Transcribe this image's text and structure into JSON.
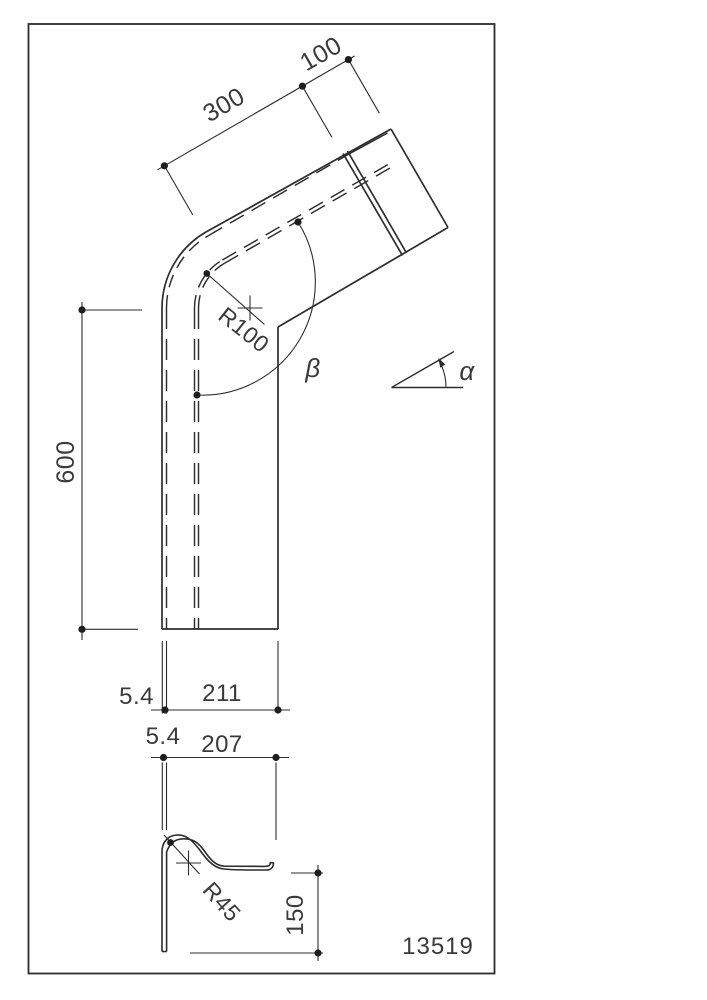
{
  "style": {
    "ink": "#2d2d2d",
    "text_color": "#3a3a3a",
    "background": "#ffffff"
  },
  "title_block": {
    "part_number": "13519"
  },
  "main_view": {
    "straight_length": "600",
    "upper_segment_length": "300",
    "end_segment_length": "100",
    "bend_radius_label": "R100",
    "bend_angle_label": "β",
    "reference_angle_label": "α"
  },
  "width_dimension": {
    "wall_thickness": "5.4",
    "overall_width": "211"
  },
  "section_view": {
    "wall_thickness": "5.4",
    "hook_width": "207",
    "hook_radius_label": "R45",
    "hook_height": "150"
  }
}
